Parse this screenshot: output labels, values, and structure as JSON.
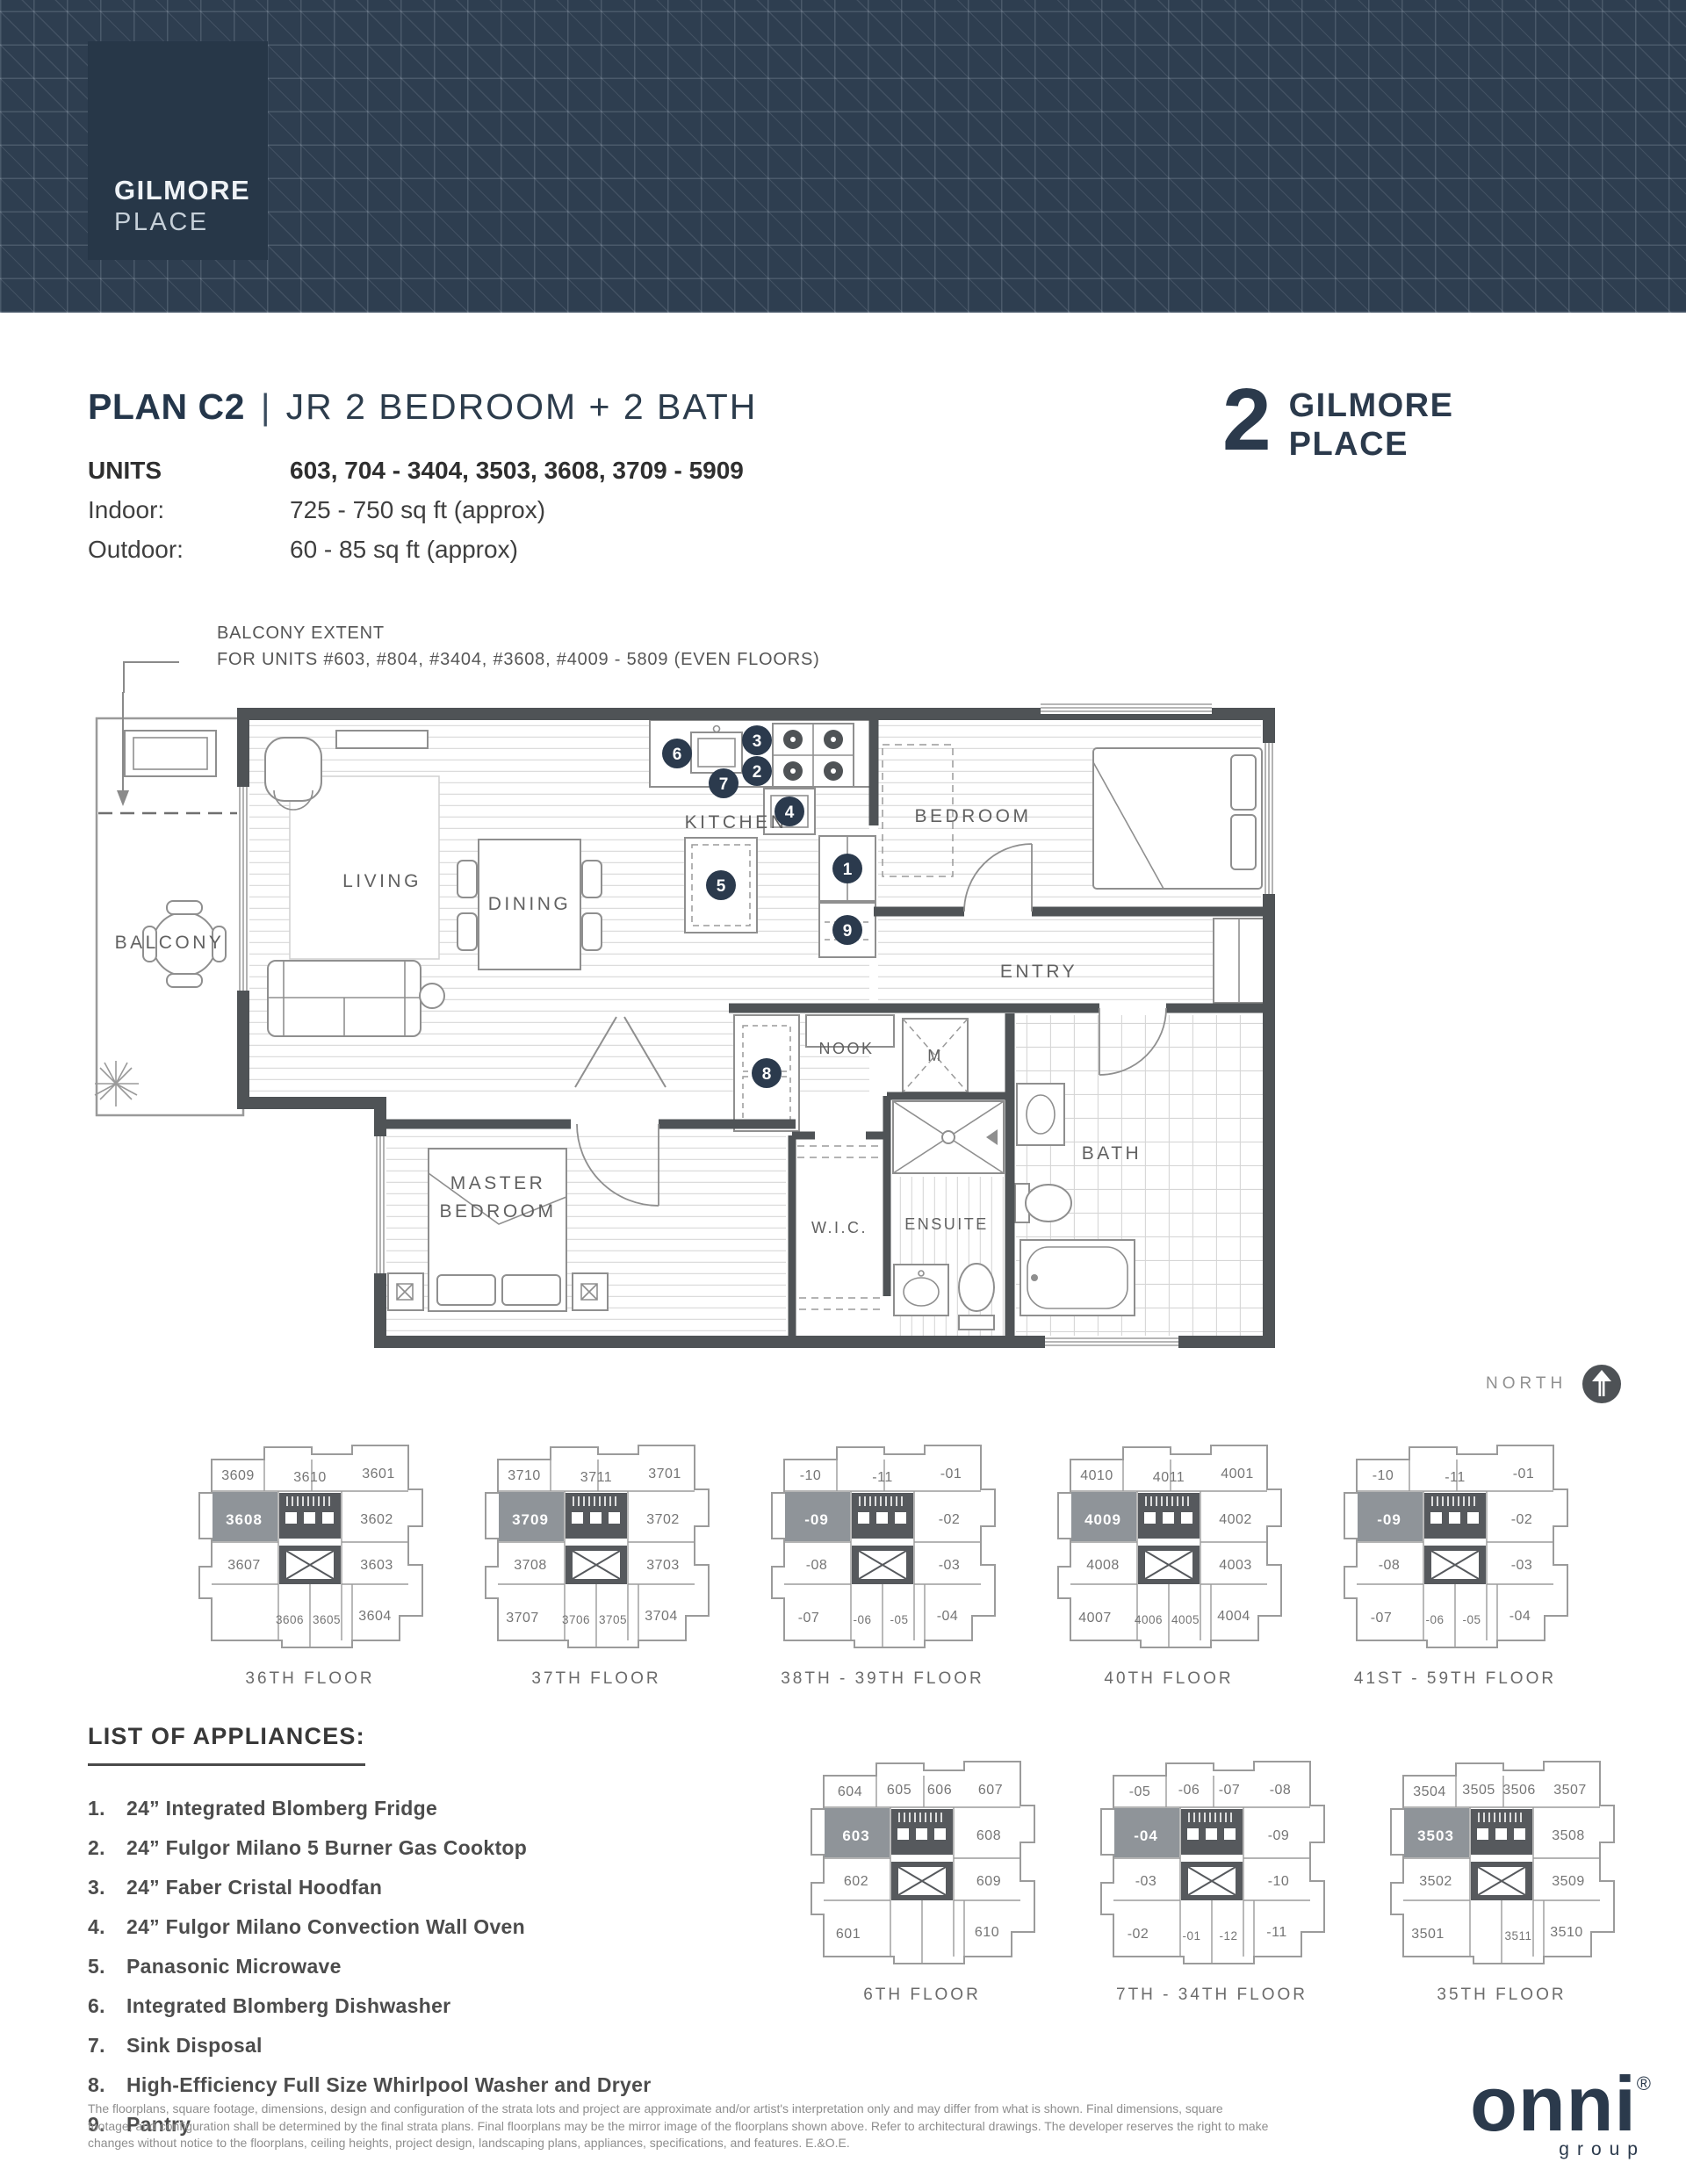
{
  "banner": {
    "logo_line1": "GILMORE",
    "logo_line2": "PLACE"
  },
  "titleblock": {
    "plan_name": "PLAN C2",
    "separator": "|",
    "plan_type": "JR 2 BEDROOM + 2 BATH",
    "tower_number": "2",
    "tower_line1": "GILMORE",
    "tower_line2": "PLACE",
    "units_label": "UNITS",
    "units_value": "603, 704 - 3404, 3503, 3608, 3709 - 5909",
    "indoor_label": "Indoor:",
    "indoor_value": "725 - 750 sq ft (approx)",
    "outdoor_label": "Outdoor:",
    "outdoor_value": "60 - 85 sq ft (approx)"
  },
  "balcony_note": {
    "line1": "BALCONY EXTENT",
    "line2": "FOR UNITS #603, #804, #3404, #3608, #4009 - 5809 (EVEN FLOORS)"
  },
  "plan": {
    "rooms": {
      "balcony": "BALCONY",
      "living": "LIVING",
      "dining": "DINING",
      "kitchen": "KITCHEN",
      "bedroom": "BEDROOM",
      "entry": "ENTRY",
      "nook": "NOOK",
      "m_closet": "M",
      "master_line1": "MASTER",
      "master_line2": "BEDROOM",
      "wic": "W.I.C.",
      "ensuite": "ENSUITE",
      "bath": "BATH"
    },
    "markers": [
      "1",
      "2",
      "3",
      "4",
      "5",
      "6",
      "7",
      "8",
      "9"
    ]
  },
  "north_label": "NORTH",
  "appliances": {
    "heading": "LIST OF APPLIANCES:",
    "items": [
      {
        "num": "1.",
        "label": "24” Integrated Blomberg Fridge"
      },
      {
        "num": "2.",
        "label": "24” Fulgor Milano 5 Burner Gas Cooktop"
      },
      {
        "num": "3.",
        "label": "24” Faber Cristal Hoodfan"
      },
      {
        "num": "4.",
        "label": "24” Fulgor Milano Convection Wall Oven"
      },
      {
        "num": "5.",
        "label": "Panasonic Microwave"
      },
      {
        "num": "6.",
        "label": "Integrated Blomberg Dishwasher"
      },
      {
        "num": "7.",
        "label": "Sink Disposal"
      },
      {
        "num": "8.",
        "label": "High-Efficiency Full Size Whirlpool Washer and Dryer"
      },
      {
        "num": "9.",
        "label": "Pantry"
      }
    ]
  },
  "keyplans": [
    {
      "floor": "36TH FLOOR",
      "row": 1,
      "units": [
        {
          "id": "3609",
          "slot": "t1"
        },
        {
          "id": "3610",
          "slot": "tc"
        },
        {
          "id": "3601",
          "slot": "t4"
        },
        {
          "id": "3608",
          "slot": "hl"
        },
        {
          "id": "3602",
          "slot": "r1"
        },
        {
          "id": "3607",
          "slot": "l2"
        },
        {
          "id": "3603",
          "slot": "r2"
        },
        {
          "id": "3606",
          "slot": "b2"
        },
        {
          "id": "3605",
          "slot": "b3"
        },
        {
          "id": "3604",
          "slot": "b4"
        }
      ]
    },
    {
      "floor": "37TH FLOOR",
      "row": 1,
      "units": [
        {
          "id": "3710",
          "slot": "t1"
        },
        {
          "id": "3711",
          "slot": "tc"
        },
        {
          "id": "3701",
          "slot": "t4"
        },
        {
          "id": "3709",
          "slot": "hl"
        },
        {
          "id": "3702",
          "slot": "r1"
        },
        {
          "id": "3708",
          "slot": "l2"
        },
        {
          "id": "3703",
          "slot": "r2"
        },
        {
          "id": "3707",
          "slot": "b1"
        },
        {
          "id": "3706",
          "slot": "b2"
        },
        {
          "id": "3705",
          "slot": "b3"
        },
        {
          "id": "3704",
          "slot": "b4"
        }
      ]
    },
    {
      "floor": "38TH - 39TH FLOOR",
      "row": 1,
      "units": [
        {
          "id": "-10",
          "slot": "t1"
        },
        {
          "id": "-11",
          "slot": "tc"
        },
        {
          "id": "-01",
          "slot": "t4"
        },
        {
          "id": "-09",
          "slot": "hl"
        },
        {
          "id": "-02",
          "slot": "r1"
        },
        {
          "id": "-08",
          "slot": "l2"
        },
        {
          "id": "-03",
          "slot": "r2"
        },
        {
          "id": "-07",
          "slot": "b1"
        },
        {
          "id": "-06",
          "slot": "b2"
        },
        {
          "id": "-05",
          "slot": "b3"
        },
        {
          "id": "-04",
          "slot": "b4"
        }
      ]
    },
    {
      "floor": "40TH FLOOR",
      "row": 1,
      "units": [
        {
          "id": "4010",
          "slot": "t1"
        },
        {
          "id": "4011",
          "slot": "tc"
        },
        {
          "id": "4001",
          "slot": "t4"
        },
        {
          "id": "4009",
          "slot": "hl"
        },
        {
          "id": "4002",
          "slot": "r1"
        },
        {
          "id": "4008",
          "slot": "l2"
        },
        {
          "id": "4003",
          "slot": "r2"
        },
        {
          "id": "4007",
          "slot": "b1"
        },
        {
          "id": "4006",
          "slot": "b2"
        },
        {
          "id": "4005",
          "slot": "b3"
        },
        {
          "id": "4004",
          "slot": "b4"
        }
      ]
    },
    {
      "floor": "41ST - 59TH FLOOR",
      "row": 1,
      "units": [
        {
          "id": "-10",
          "slot": "t1"
        },
        {
          "id": "-11",
          "slot": "tc"
        },
        {
          "id": "-01",
          "slot": "t4"
        },
        {
          "id": "-09",
          "slot": "hl"
        },
        {
          "id": "-02",
          "slot": "r1"
        },
        {
          "id": "-08",
          "slot": "l2"
        },
        {
          "id": "-03",
          "slot": "r2"
        },
        {
          "id": "-07",
          "slot": "b1"
        },
        {
          "id": "-06",
          "slot": "b2"
        },
        {
          "id": "-05",
          "slot": "b3"
        },
        {
          "id": "-04",
          "slot": "b4"
        }
      ]
    },
    {
      "floor": "6TH FLOOR",
      "row": 2,
      "units": [
        {
          "id": "604",
          "slot": "t1"
        },
        {
          "id": "605",
          "slot": "t2"
        },
        {
          "id": "606",
          "slot": "t3"
        },
        {
          "id": "607",
          "slot": "t4"
        },
        {
          "id": "603",
          "slot": "hl"
        },
        {
          "id": "608",
          "slot": "r1"
        },
        {
          "id": "602",
          "slot": "l2"
        },
        {
          "id": "609",
          "slot": "r2"
        },
        {
          "id": "601",
          "slot": "b1"
        },
        {
          "id": "610",
          "slot": "b4"
        }
      ]
    },
    {
      "floor": "7TH - 34TH FLOOR",
      "row": 2,
      "units": [
        {
          "id": "-05",
          "slot": "t1"
        },
        {
          "id": "-06",
          "slot": "t2"
        },
        {
          "id": "-07",
          "slot": "t3"
        },
        {
          "id": "-08",
          "slot": "t4"
        },
        {
          "id": "-04",
          "slot": "hl"
        },
        {
          "id": "-09",
          "slot": "r1"
        },
        {
          "id": "-03",
          "slot": "l2"
        },
        {
          "id": "-10",
          "slot": "r2"
        },
        {
          "id": "-02",
          "slot": "b1"
        },
        {
          "id": "-01",
          "slot": "b2"
        },
        {
          "id": "-12",
          "slot": "b3"
        },
        {
          "id": "-11",
          "slot": "b4"
        }
      ]
    },
    {
      "floor": "35TH FLOOR",
      "row": 2,
      "units": [
        {
          "id": "3504",
          "slot": "t1"
        },
        {
          "id": "3505",
          "slot": "t2"
        },
        {
          "id": "3506",
          "slot": "t3"
        },
        {
          "id": "3507",
          "slot": "t4"
        },
        {
          "id": "3503",
          "slot": "hl"
        },
        {
          "id": "3508",
          "slot": "r1"
        },
        {
          "id": "3502",
          "slot": "l2"
        },
        {
          "id": "3509",
          "slot": "r2"
        },
        {
          "id": "3501",
          "slot": "b1"
        },
        {
          "id": "3511",
          "slot": "b3"
        },
        {
          "id": "3510",
          "slot": "b4"
        }
      ]
    }
  ],
  "footer": {
    "disclaimer": "The floorplans, square footage, dimensions, design and configuration of the strata lots and project are approximate and/or artist's interpretation only and may differ from what is shown. Final dimensions, square footage, and configuration shall be determined by the final strata plans. Final floorplans may be the mirror image of the floorplans shown above. Refer to architectural drawings. The developer reserves the right to make changes without notice to the floorplans, ceiling heights, project design, landscaping plans, appliances, specifications, and features. E.&O.E.",
    "brand": "onni",
    "brand_reg": "®",
    "brand_sub": "group"
  }
}
